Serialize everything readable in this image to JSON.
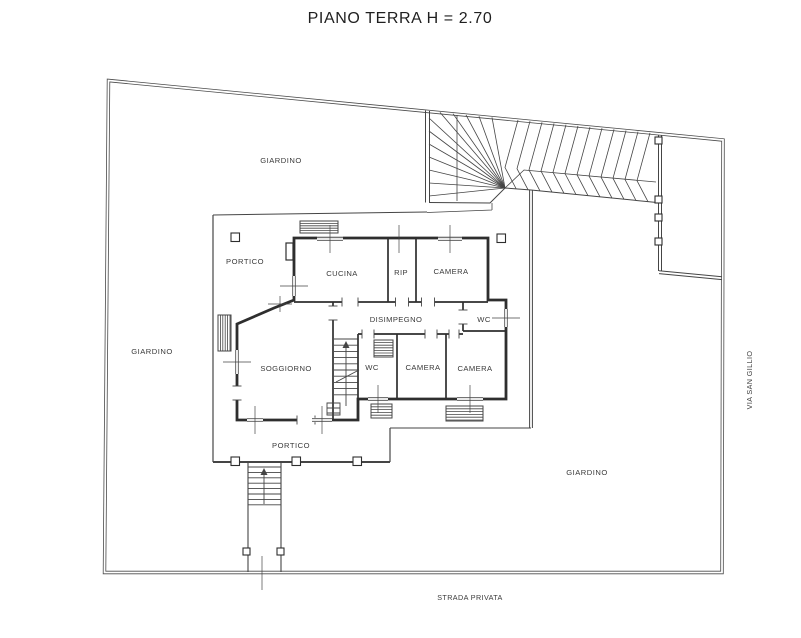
{
  "title": "PIANO TERRA H = 2.70",
  "areas": {
    "garden_top": "GIARDINO",
    "garden_left": "GIARDINO",
    "garden_right": "GIARDINO",
    "portico_top": "PORTICO",
    "portico_bottom": "PORTICO"
  },
  "rooms": {
    "kitchen": "CUCINA",
    "storage": "RIP",
    "bedroom_top": "CAMERA",
    "hallway": "DISIMPEGNO",
    "wc_top": "WC",
    "living": "SOGGIORNO",
    "wc_lower": "WC",
    "bedroom_mid": "CAMERA",
    "bedroom_right": "CAMERA"
  },
  "streets": {
    "right": "VIA SAN GILLIO",
    "bottom": "STRADA PRIVATA"
  },
  "colors": {
    "line": "#454545",
    "wall": "#2e2e2e",
    "background": "#ffffff"
  }
}
